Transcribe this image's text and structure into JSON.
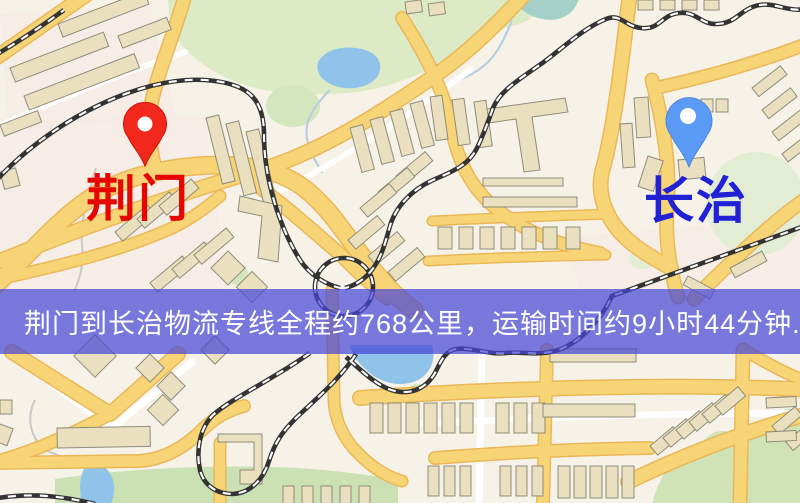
{
  "banner": {
    "text": "荆门到长治物流专线全程约768公里，运输时间约9小时44分钟.",
    "background_color": "rgba(70,70,215,0.72)",
    "text_color": "#ffffff"
  },
  "route": {
    "origin": "荆门",
    "destination": "长治",
    "distance_text": "约768公里",
    "duration_text": "约9小时44分钟"
  },
  "origin_marker": {
    "label": "荆门",
    "label_color": "#e60600",
    "pin_color": "#f1281b"
  },
  "destination_marker": {
    "label": "长治",
    "label_color": "#2121d6",
    "pin_color": "#5b9bf5"
  },
  "map_palette": {
    "base": "#f7f2e8",
    "road": "#f7d577",
    "road_casing": "#eab858",
    "building": "#eae0c0",
    "park": "#dcebc6",
    "water": "#8fc3ea",
    "railway": "#333333"
  }
}
